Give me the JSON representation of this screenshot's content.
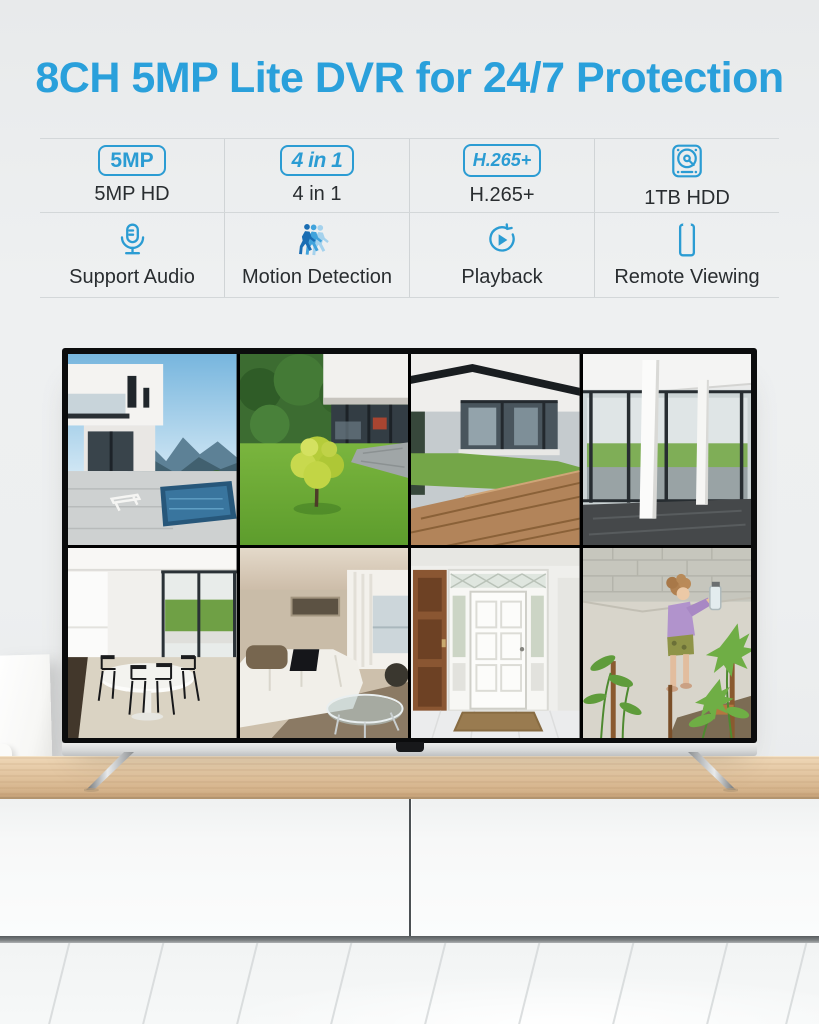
{
  "title": "8CH 5MP Lite DVR for 24/7 Protection",
  "colors": {
    "title_blue": "#2aa0db",
    "icon_blue": "#2b9cd3",
    "label_dark": "#292d30",
    "wall_gray": "#edeff0",
    "wood_shelf": "#e2c5a0"
  },
  "features": {
    "items": [
      {
        "kind": "badge",
        "icon": "badge-5mp",
        "badge": "5MP",
        "label": "5MP HD"
      },
      {
        "kind": "badge",
        "icon": "badge-4in1",
        "badge": "4 in 1",
        "label": "4 in 1"
      },
      {
        "kind": "badge",
        "icon": "badge-h265",
        "badge": "H.265+",
        "label": "H.265+"
      },
      {
        "kind": "icon",
        "icon": "hard-drive-icon",
        "badge": "",
        "label": "1TB HDD"
      },
      {
        "kind": "icon",
        "icon": "microphone-icon",
        "badge": "",
        "label": "Support Audio"
      },
      {
        "kind": "icon",
        "icon": "motion-detection-icon",
        "badge": "",
        "label": "Motion Detection"
      },
      {
        "kind": "icon",
        "icon": "playback-icon",
        "badge": "",
        "label": "Playback"
      },
      {
        "kind": "icon",
        "icon": "smartphone-icon",
        "badge": "",
        "label": "Remote Viewing"
      }
    ]
  },
  "tv": {
    "feeds": [
      {
        "name": "camera-feed-1",
        "scene": "modern villa with pool and mountain view"
      },
      {
        "name": "camera-feed-2",
        "scene": "backyard lawn with young tree and glass house"
      },
      {
        "name": "camera-feed-3",
        "scene": "house facade with lawn and wooden deck"
      },
      {
        "name": "camera-feed-4",
        "scene": "glass corridor with white columns"
      },
      {
        "name": "camera-feed-5",
        "scene": "dining room with oval table and black chairs"
      },
      {
        "name": "camera-feed-6",
        "scene": "living room with white sofa and glass table"
      },
      {
        "name": "camera-feed-7",
        "scene": "entrance hall with white front door"
      },
      {
        "name": "camera-feed-8",
        "scene": "child playing near garden plants"
      }
    ]
  }
}
